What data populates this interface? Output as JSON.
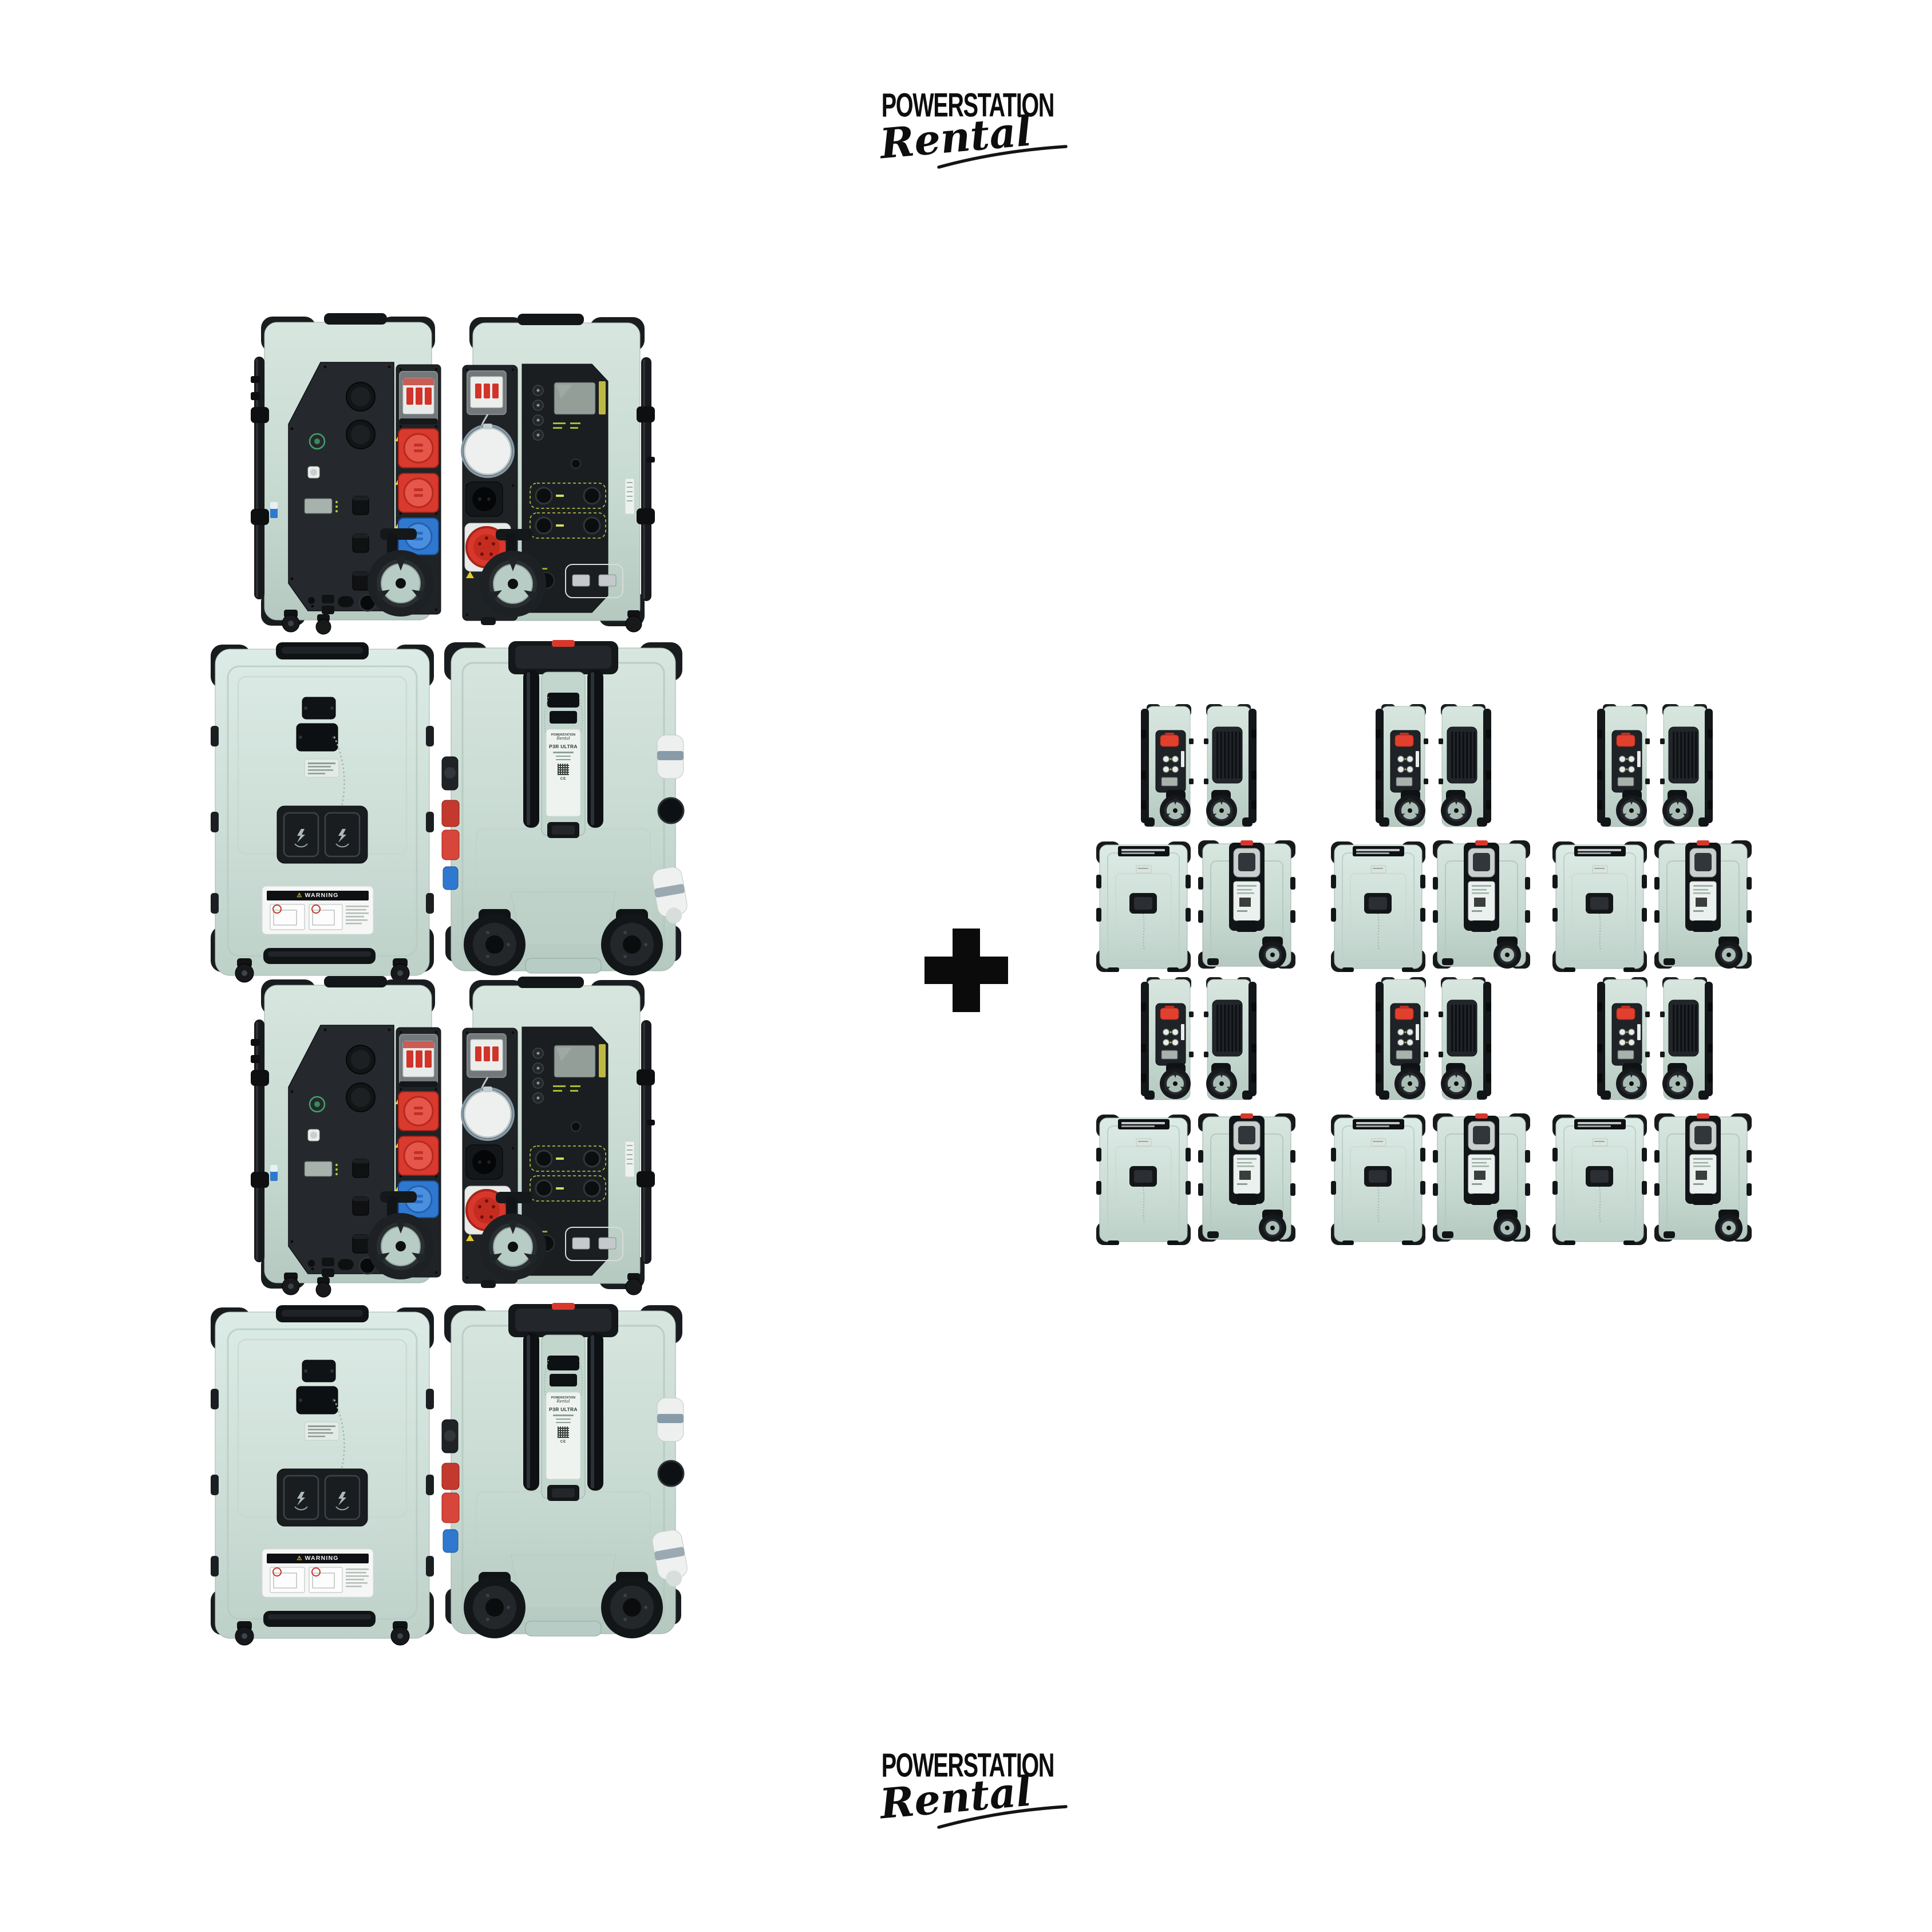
{
  "logo": {
    "title": "POWERSTATION",
    "subtitle": "Rental"
  },
  "separator": {
    "symbol": "+"
  },
  "product": {
    "name": "P3R ULTRA",
    "brand": "POWERSTATION",
    "brand_script": "Rental",
    "cert": "CE"
  },
  "labels": {
    "warning": "WARNING",
    "warning_icon": "⚠"
  },
  "left_cluster": {
    "groups": 2,
    "views": [
      "side-panel-controls",
      "side-panel-display",
      "front-flat",
      "rear-trolley"
    ]
  },
  "right_cluster": {
    "rows": 2,
    "columns": 3,
    "groups": 6,
    "views": [
      "slim-side-controls",
      "slim-side-vent",
      "lid-flat",
      "rear-trolley"
    ]
  },
  "palette": {
    "body_green": "#c8dbd3",
    "body_light": "#d9e8e2",
    "body_shade": "#aec5bd",
    "panel_dark": "#24282b",
    "ink": "#14171a",
    "red": "#d8372c",
    "red_bright": "#e8503f",
    "blue": "#3179cf",
    "white": "#f1f4f2",
    "steel": "#c6cdcf",
    "screen_grey": "#97a19c",
    "lime": "#b9cc35",
    "hub_green": "#b6cbc3"
  }
}
